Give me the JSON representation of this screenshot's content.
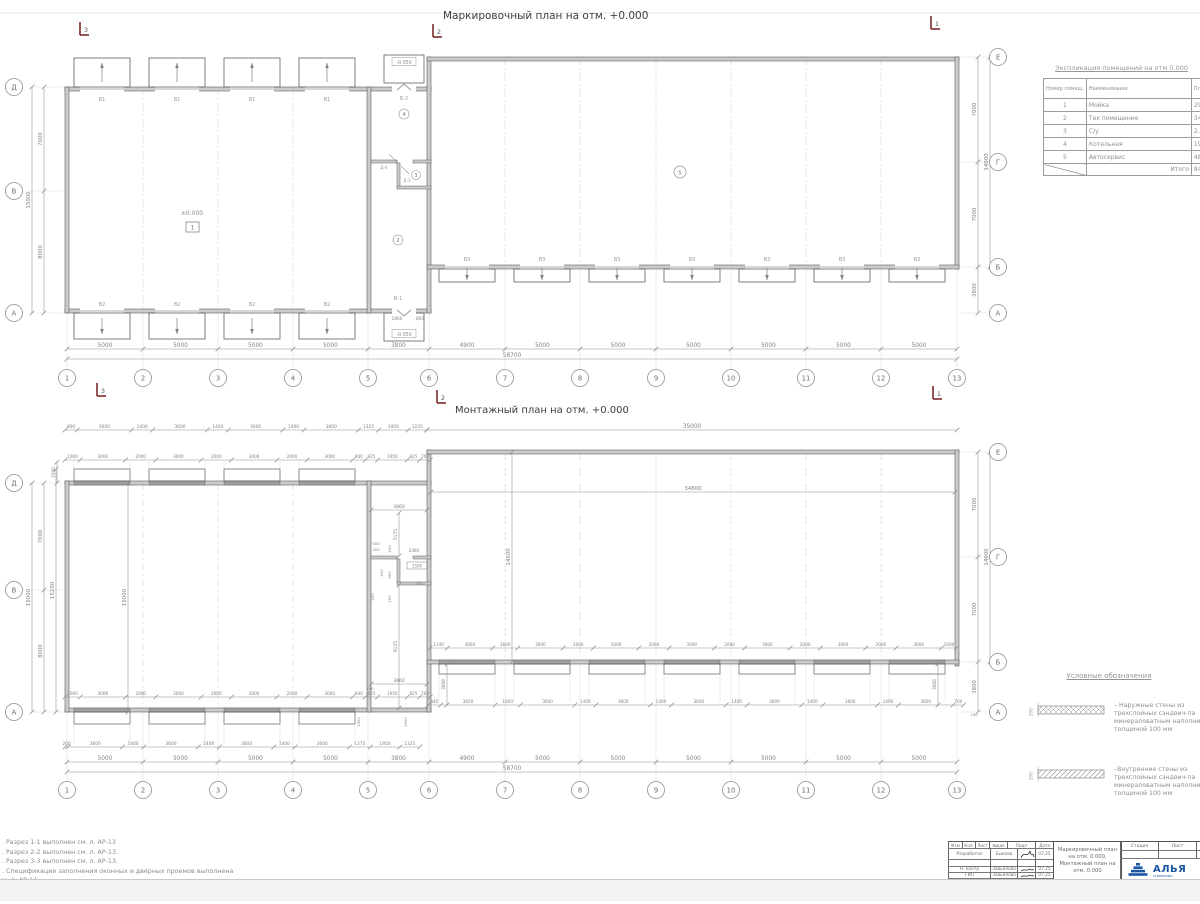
{
  "colors": {
    "line": "#5f5f5f",
    "wall_fill": "#cbcbcb",
    "dim": "#8f8f8f",
    "dim_text": "#828282",
    "label": "#9a9a9a",
    "title": "#3d3d3d",
    "axis": "#8f8f8f",
    "dash": "#c9c9c9",
    "section": "#7d2a2a",
    "logo_blue": "#1c57a5",
    "sig": "#2b2b2b"
  },
  "axes": {
    "numbers": [
      "1",
      "2",
      "3",
      "4",
      "5",
      "6",
      "7",
      "8",
      "9",
      "10",
      "11",
      "12",
      "13"
    ],
    "left_letters": [
      "Д",
      "В",
      "А"
    ],
    "right_letters": [
      "Е",
      "Г",
      "Б",
      "А"
    ],
    "span_dims": [
      "5000",
      "5000",
      "5000",
      "5000",
      "3800",
      "4900",
      "5000",
      "5000",
      "5000",
      "5000",
      "5000",
      "5000"
    ],
    "span_total": "58700",
    "left_dims": [
      "7000",
      "8000"
    ],
    "left_total": "15000",
    "right_dims": [
      "7000",
      "7000",
      "3800"
    ],
    "right_total": "14000"
  },
  "sections": {
    "m1": "1",
    "m2": "2",
    "m3": "3"
  },
  "top_plan": {
    "title": "Маркировочный план на отм. +0.000",
    "level_zero": "±0.000",
    "room_box": "1",
    "porch_level": "-0.050",
    "gate_top": "В1",
    "gate_bottom": "В2",
    "gate_right": "В3",
    "door_top": "В-2",
    "door_bottom": "В-1",
    "door_d3": "Д-3",
    "door_d4": "Д-4",
    "room2": "2",
    "room3": "3",
    "room4": "4",
    "room5": "5",
    "door_dims": [
      "1800",
      "800"
    ]
  },
  "bottom_plan": {
    "title": "Монтажный план на отм. +0.000",
    "row_a": [
      "800",
      "3600",
      "1400",
      "3600",
      "1400",
      "3600",
      "1400",
      "3600",
      "1325",
      "1950",
      "1225"
    ],
    "row_b": [
      "1000",
      "3000",
      "2000",
      "3000",
      "2000",
      "3000",
      "2000",
      "3000",
      "840",
      "825",
      "1950",
      "825",
      "700"
    ],
    "lb_row1": [
      "1000",
      "3000",
      "2000",
      "3000",
      "2000",
      "3000",
      "2000",
      "3000",
      "840",
      "825",
      "1950",
      "825",
      "700"
    ],
    "lb_row2": [
      "200",
      "3600",
      "1400",
      "3600",
      "1400",
      "3600",
      "1400",
      "3600",
      "1375",
      "1950",
      "1325"
    ],
    "rb_row1": [
      "1140",
      "3000",
      "1660",
      "3000",
      "2000",
      "3000",
      "2000",
      "3000",
      "2000",
      "3000",
      "2000",
      "3000",
      "2000",
      "3000",
      "1000"
    ],
    "rb_row2": [
      "840",
      "3600",
      "1660",
      "3600",
      "1400",
      "3600",
      "1400",
      "3600",
      "1400",
      "3600",
      "1400",
      "3600",
      "1400",
      "3600",
      "700"
    ],
    "right_total": "35000",
    "right_inner": "34800",
    "v_inner_left": "15000",
    "v_outer_left": "15200",
    "v_inner_right": "14500",
    "v_1500": "1500",
    "v_3000": "3000",
    "v_100": "100",
    "v_1600": "1600",
    "v_1500b": "1500",
    "conn": {
      "c3860a": "3860",
      "c5175": "5175",
      "c500": "500",
      "c300": "300",
      "c100a": "100",
      "c2460": "2460",
      "c1500": "1500",
      "c400": "400",
      "c900": "900",
      "c100b": "100",
      "c200": "200",
      "c100c": "100",
      "c8125": "8125",
      "c3860b": "3860",
      "c160": "160"
    }
  },
  "room_table": {
    "title": "Экспликация помещений на отм 0.000",
    "col_no": "Номер помещ.",
    "col_name": "Наименование",
    "col_area": "Площадь",
    "rows": [
      [
        "1",
        "Мойка",
        "297,"
      ],
      [
        "2",
        "Тех помещение",
        "34,"
      ],
      [
        "3",
        "С/у",
        "2,2"
      ],
      [
        "4",
        "Котельная",
        "19,"
      ],
      [
        "5",
        "Автосервис",
        "486,"
      ]
    ],
    "total_label": "Итого",
    "total_value": "841,"
  },
  "legend": {
    "title": "Условные обозначения",
    "dim": "100",
    "items": [
      {
        "lines": [
          "– Наружные стены из",
          "трехслойных сэндвич-па",
          "минераловатным наполни",
          "толщиной 100 мм"
        ]
      },
      {
        "lines": [
          "–Внутренние стены из",
          "трехслойных сэндвич-па",
          "минераловатным наполни",
          "толщиной 100 мм"
        ]
      }
    ]
  },
  "notes": {
    "lines": [
      ". Разрез 1-1 выполнен см. л. АР-13",
      ". Разрез 2-2 выполнен см. л. АР-13.",
      ". Разрез 3-3 выполнен см. л. АР-13.",
      ". Спецификация заполнения оконных и дверных проемов выполнена",
      "м. л. АР-14.",
      ". Экспликация полов выполнена см. л. АР-14"
    ]
  },
  "title_block": {
    "header": [
      "Изм",
      "Кол.",
      "Лист",
      "№док",
      "Подп",
      "Дата"
    ],
    "rows": [
      {
        "role": "Разработал",
        "name": "Быкова",
        "date": "07.25"
      },
      {
        "role": "Н. контр",
        "name": "Завьялова",
        "date": "07.25"
      },
      {
        "role": "ГИП",
        "name": "Завьялова",
        "date": "07.25"
      }
    ],
    "doc_title_1": "Маркировочный план на отм. 0.000,",
    "doc_title_2": "Монтажный план на отм. 0.000",
    "stage_label": "Стадия",
    "sheet_label": "Лист",
    "logo_text": "АЛЬЯ",
    "logo_sub": "строительн"
  }
}
